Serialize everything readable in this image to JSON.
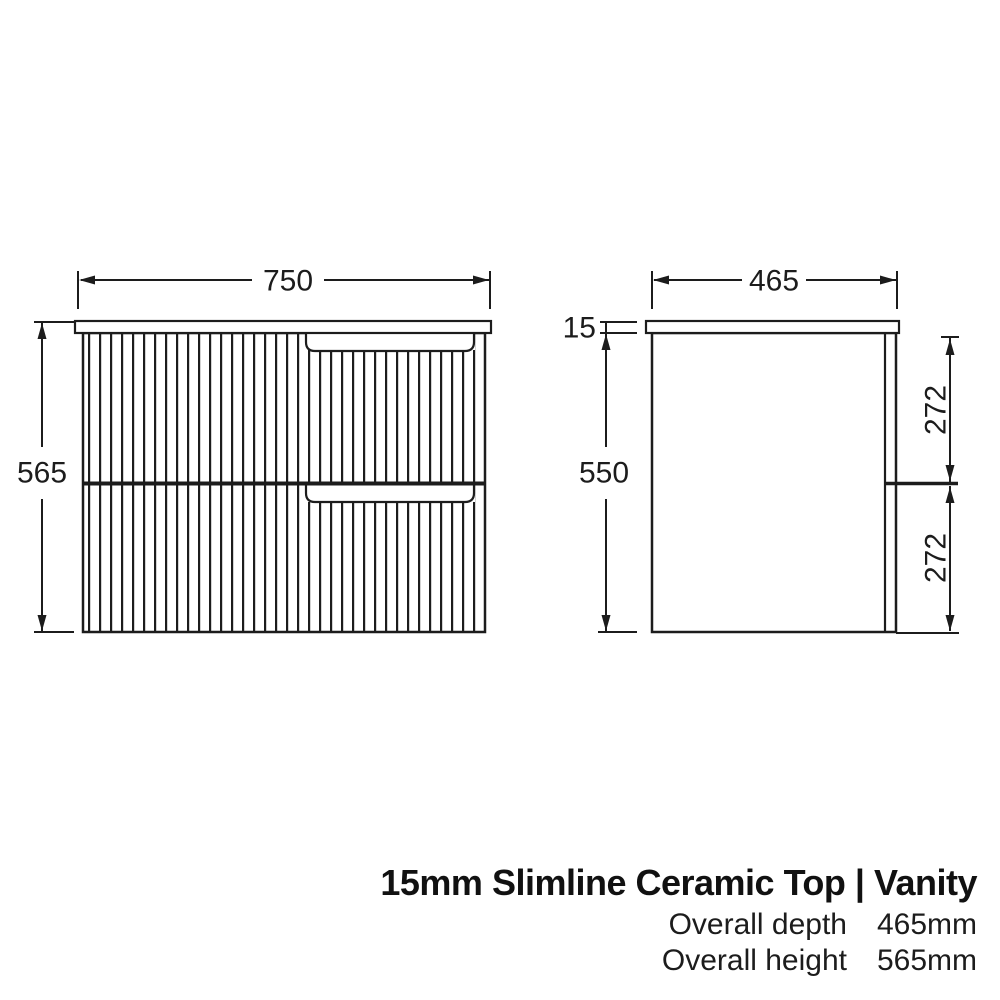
{
  "front_view": {
    "name": "vanity front elevation",
    "width_dim": "750",
    "height_dim": "565"
  },
  "side_view": {
    "name": "vanity side profile",
    "depth_dim": "465",
    "top_thickness_dim": "15",
    "cabinet_height_dim": "550",
    "top_drawer_dim": "272",
    "bottom_drawer_dim": "272"
  },
  "title_block": {
    "title": "15mm Slimline Ceramic Top | Vanity",
    "specs": [
      {
        "label": "Overall depth",
        "value": "465mm"
      },
      {
        "label": "Overall height",
        "value": "565mm"
      }
    ]
  },
  "colors": {
    "line": "#1c1c1c",
    "background": "#ffffff"
  }
}
